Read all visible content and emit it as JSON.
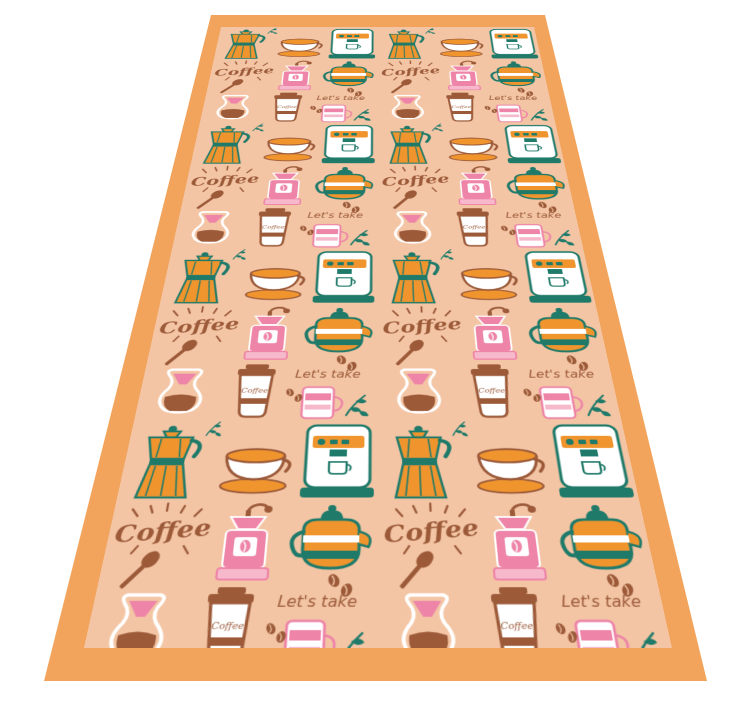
{
  "scene": {
    "background": "#ffffff",
    "description": "coffee-pattern runner shown in perspective"
  },
  "runner": {
    "border_color": "#f2a45c",
    "pattern_background": "#f3c5a4",
    "colors": {
      "orange": "#f0952e",
      "teal": "#1f7a6a",
      "pink": "#ee84a8",
      "light_pink": "#f6b9cb",
      "brown": "#9c5a39",
      "white": "#ffffff"
    },
    "texts": {
      "coffee_script": "Coffee",
      "lets_take": "Let's take",
      "cup_label": "Coffee"
    },
    "motifs": [
      "moka-pot",
      "cappuccino-cup",
      "espresso-machine",
      "coffee-script",
      "coffee-grinder",
      "striped-teapot",
      "pour-over-brewer",
      "takeaway-cup",
      "lets-take-script",
      "latte-glass",
      "coffee-beans",
      "leaf-sprig",
      "spoon"
    ],
    "geometry": {
      "outer_quad": [
        [
          211,
          15
        ],
        [
          545,
          15
        ],
        [
          707,
          681
        ],
        [
          44,
          681
        ]
      ],
      "inner_quad": [
        [
          221,
          27
        ],
        [
          534,
          27
        ],
        [
          672,
          648
        ],
        [
          84,
          648
        ]
      ]
    }
  }
}
